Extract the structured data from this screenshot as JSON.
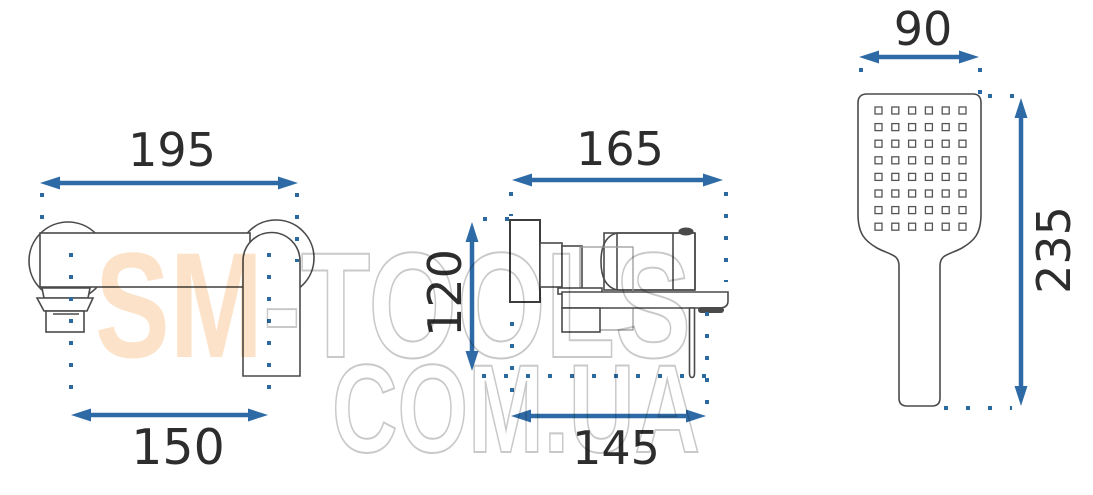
{
  "watermark": {
    "brand_filled": "SM",
    "brand_outline": "-TOOLS",
    "domain_line": "COM.UA"
  },
  "dimensions": {
    "front_view": {
      "top_width": "195",
      "spout_span": "150"
    },
    "side_view": {
      "depth": "165",
      "height": "120",
      "bottom_depth": "145"
    },
    "hand_shower": {
      "head_width": "90",
      "length": "235"
    }
  },
  "nozzle_grid": {
    "cols": 6,
    "rows": 8
  },
  "colors": {
    "dimension_blue": "#2e6ba6",
    "extension_dot_blue": "#2c699f",
    "outline_dark": "#4a4a4a",
    "outline_light_gray": "#9b9b9b",
    "watermark_peach": "#fbe2c8",
    "watermark_outline_gray": "#c9c9c9",
    "label_text": "#2d2d2d",
    "background": "#ffffff"
  }
}
